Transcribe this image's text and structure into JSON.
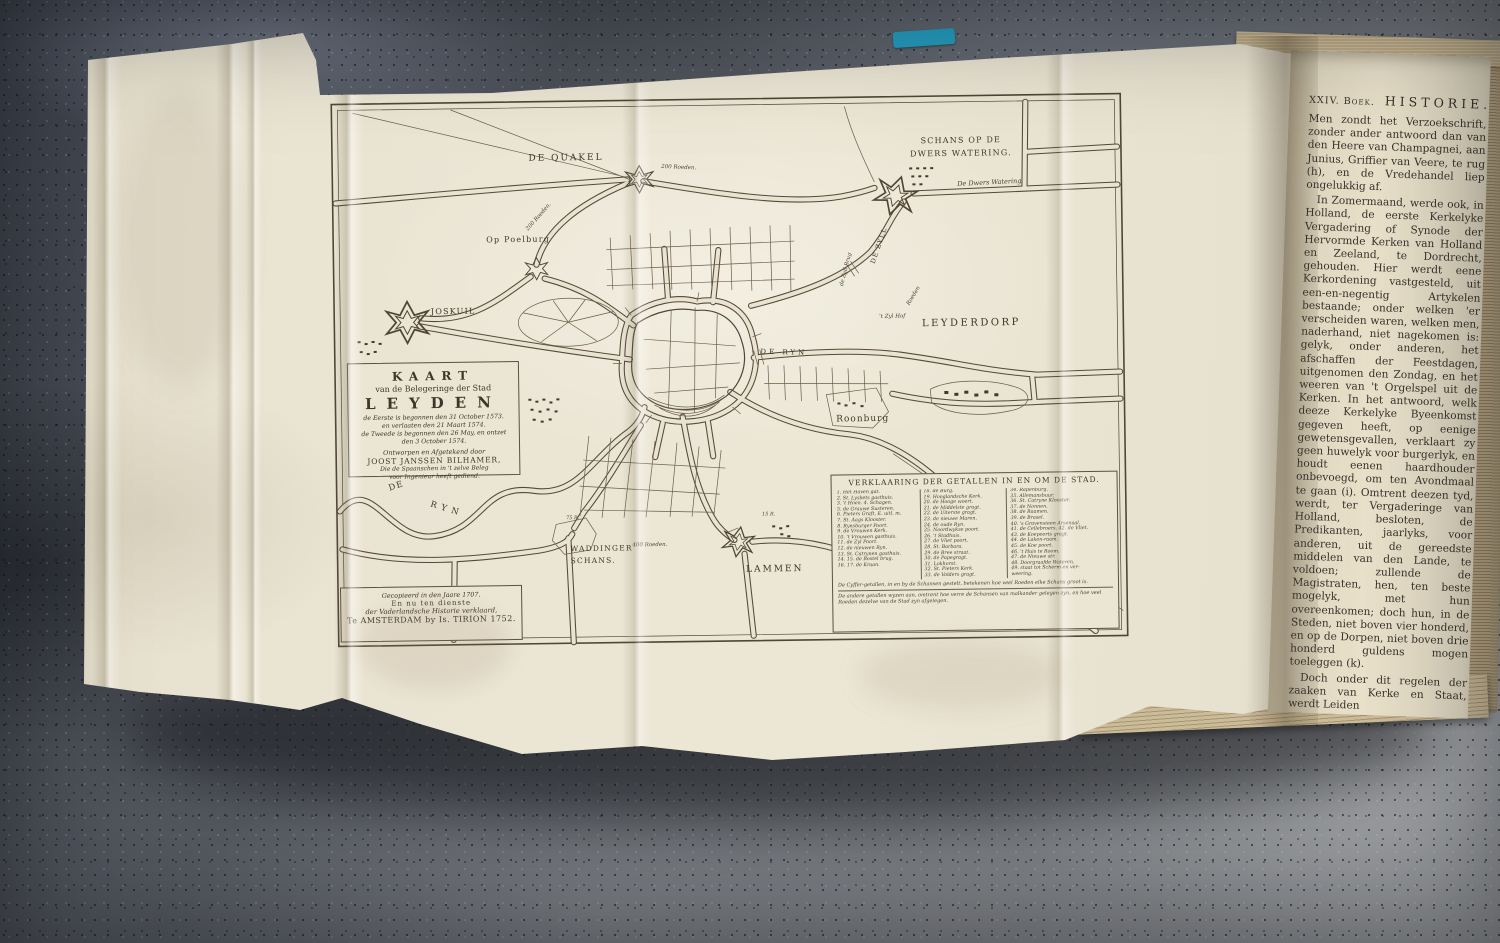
{
  "photo": {
    "description": "Open antique book with engraved fold-out siege map on a granite countertop",
    "bookmark_color": "#259fc3",
    "paper_color": "#eae4d3",
    "ink_color": "#4f4636"
  },
  "map": {
    "cartouche": {
      "title": "KAART",
      "subtitle": "van de Belegeringe der Stad",
      "city": "LEYDEN",
      "dates": [
        "de Eerste is begonnen den 31 October 1573.",
        "en verlaaten den 21 Maart 1574.",
        "de Tweede is begonnen den 26 May, en ontzet",
        "den 3 October 1574."
      ],
      "attr1": "Ontworpen en Afgetekend door",
      "attr2": "JOOST JANSSEN BILHAMER,",
      "attr3": "Die de Spaanschen in 't zelve Beleg",
      "attr4": "voor Ingenieur heeft gediend."
    },
    "imprint": {
      "line1": "Gecopieerd in den Jaare 1707.",
      "line2": "En nu ten dienste",
      "line3": "der Vaderlandsche Historie verklaard,",
      "line4": "Te AMSTERDAM by Is. TIRION 1752."
    },
    "place_labels": {
      "quakel": "DE QUAKEL",
      "schans1": "SCHANS OP DE",
      "schans2": "DWERS WATERING.",
      "dwers": "De Dwers Watering",
      "leyderdorp": "LEYDERDORP",
      "poelburg": "Op Poelburg",
      "joskuil": "JOSKUIL",
      "rijn_de": "DE",
      "rijn_ryn": "RYN",
      "rijn_east": "DE RYN",
      "zyl": "DE ZYLL",
      "zyl_brug": "de Zyll Brug",
      "zyl_hof": "'t Zyl Hof",
      "roonburg": "Roonburg",
      "waddinger1": "WADDINGER",
      "waddinger2": "SCHANS.",
      "lammen": "LAMMEN"
    },
    "annotations": {
      "d200a": "200 Roeden.",
      "d200b": "200 Roeden.",
      "d400": "400  Roeden.",
      "r75": "75 R.",
      "r15": "15 R.",
      "roeden_v": "Roeden"
    },
    "legend": {
      "title": "VERKLAARING DER GETALLEN IN EN OM DE STAD.",
      "col1": [
        "1. Het Haven gat.",
        "2. St. Lysbets gasthuis.",
        "3. 't Hoen. 4. Schagen.",
        "5. de Grauwe Susteren.",
        "6. Pieters Graft, E. uitl. m.",
        "7. St. Aags Klooster.",
        "8. Rynsburger Poort.",
        "9. de Vrouwen Kerk.",
        "10. 't Vrouwen gasthuis.",
        "11. de Zyl Poort.",
        "12. de nieuwen Ryn.",
        "13. St. Catrynen gasthuis.",
        "14. 15. de Bostel brug.",
        "16. 17. de Kraan."
      ],
      "col2": [
        "18. de Burg.",
        "19. Hooglandsche Kerk.",
        "20. de Hooge woert.",
        "21. de Middelste gragt.",
        "22. de Uiterste gragt.",
        "23. de nieuwe Maren.",
        "24. de oude Ryn.",
        "25. Noordwykse poort.",
        "26. 't Stadhuis.",
        "27. de Vliet poort.",
        "28. St. Barbara.",
        "29. de Bree straat.",
        "30. de Papegragt.",
        "31. Lokhorst.",
        "32. St. Pieters Kerk.",
        "33. de Volders gragt."
      ],
      "col3": [
        "34. Rapenburg.",
        "35. Allemansbuur.",
        "36. St. Catryne Klooster.",
        "37. de Nonnen.",
        "38. de Raamen.",
        "39. de Brasel.",
        "40. 's Gravensteen Arsenaal.",
        "41. de Cellebroers. 42. de Vliet.",
        "43. de Koepoorts gragt.",
        "44. de Laken-raam.",
        "45. de Koe poort.",
        "46. 't Huis te Room.",
        "47. de Nieuwe str.",
        "48. Doorgraafde Wateren,",
        "49. staat tot Scherm en ver-",
        "weering."
      ],
      "note1": "De Cyffer-getallen, in en by de Schansen gestelt, betekenen hoe veel Roeden elke Schans groot is.",
      "note2": "De andere getallen wyzen aan, omtrent hoe verre de Schansen van malkander gelegen zyn, en hoe veel Roeden dezelve van de Stad zyn afgelegen."
    }
  },
  "right_page": {
    "header_book": "XXIV. Boek.",
    "header_title": "HISTORIE.",
    "header_page": "4",
    "p1": "Men zondt het Verzoekschrift, zonder ander antwoord dan van den Heere van Champagnei, aan Junius, Griffier van Veere, te rug (h), en de Vredehandel liep ongelukkig af.",
    "p2": "In Zomermaand, werde ook, in Holland, de eerste Kerkelyke Vergadering of Synode der Hervormde Kerken van Holland en Zeeland, te Dordrecht, gehouden. Hier werdt eene Kerkordening vastgesteld, uit een-en-negentig Artykelen bestaande; onder welken 'er verscheiden waren, welken men, naderhand, niet nagekomen is: gelyk, onder anderen, het afschaffen der Feestdagen, uitgenomen den Zondag, en het weeren van 't Orgelspel uit de Kerken. In het antwoord, welk deeze Kerkelyke Byeenkomst gegeven heeft, op eenige gewetensgevallen, verklaart zy geen huwelyk voor burgerlyk, en houdt eenen haardhouder onbevoegd, om ten Avondmaal te gaan (i). Omtrent deezen tyd, werdt, ter Vergaderinge van Holland, besloten, de Predikanten, jaarlyks, voor anderen, uit de gereedste middelen van den Lande, te voldoen; zullende de Magistraten, hen, ten beste mogelyk, met hun overeenkomen; doch hun, in de Steden, niet boven vier honderd, en op de Dorpen, niet boven drie honderd guldens mogen toeleggen (k).",
    "p3": "Doch onder dit regelen der zaaken van Kerke en Staat, werdt Leiden",
    "footnotes": [
      "(h) Bor. VII. Boek, bl. 43 enz. Hooft, bl. 52.",
      "(i) Bor. VII. Boek, bl. 50 enz. (54 enz.)",
      "(k) Resol. Holl. 26 Novemb. 1574. bl. 85."
    ],
    "sig_left": "VI. Deel.",
    "sig_right": "Hh"
  }
}
